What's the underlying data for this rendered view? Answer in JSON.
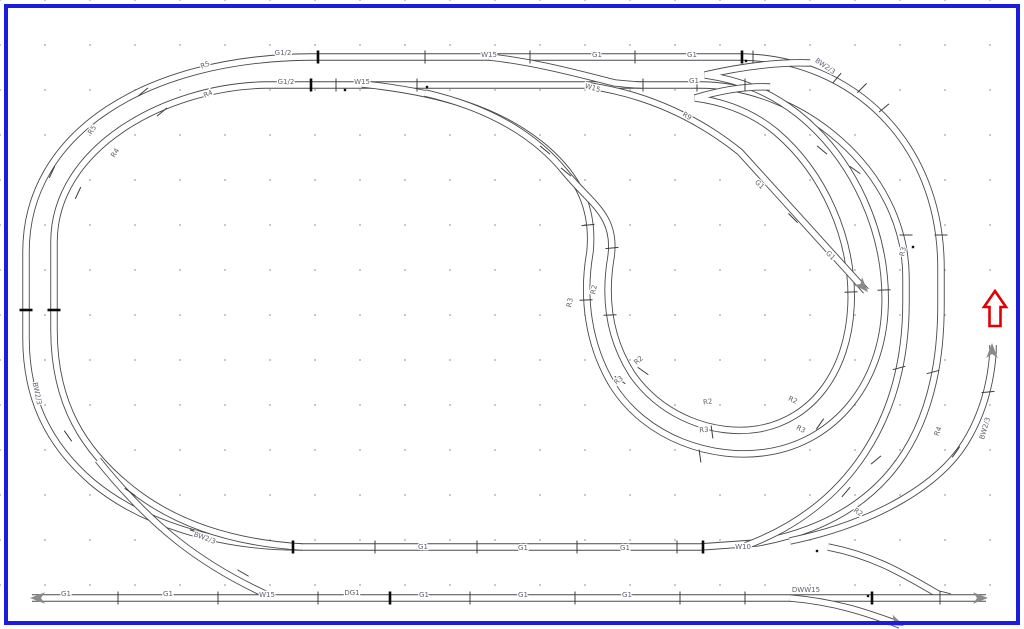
{
  "palette": {
    "frame": "#1c1ce0",
    "track": "#4a4a4a",
    "tick": "#3c3c3c",
    "tick_strong": "#0a0a0a",
    "label": "#5f5f6e",
    "end_arrow": "#8a8a8a",
    "red_arrow": "#e00000",
    "grid_dot": "#b5b5b5"
  },
  "plan": {
    "labels": [
      {
        "text": "G1/2",
        "x": 283,
        "y": 55,
        "r": 0
      },
      {
        "text": "W15",
        "x": 489,
        "y": 57,
        "r": 0
      },
      {
        "text": "G1",
        "x": 597,
        "y": 57,
        "r": 0
      },
      {
        "text": "G1",
        "x": 692,
        "y": 57,
        "r": 0
      },
      {
        "text": "BW2/3",
        "x": 824,
        "y": 68,
        "r": 35
      },
      {
        "text": "G1/2",
        "x": 286,
        "y": 84,
        "r": 0
      },
      {
        "text": "W15",
        "x": 362,
        "y": 84,
        "r": 0
      },
      {
        "text": "W15",
        "x": 592,
        "y": 90,
        "r": 16
      },
      {
        "text": "G1",
        "x": 694,
        "y": 83,
        "r": 0
      },
      {
        "text": "R9",
        "x": 686,
        "y": 118,
        "r": 30
      },
      {
        "text": "R5",
        "x": 206,
        "y": 67,
        "r": -22
      },
      {
        "text": "R4",
        "x": 209,
        "y": 96,
        "r": -24
      },
      {
        "text": "R5",
        "x": 94,
        "y": 131,
        "r": -58
      },
      {
        "text": "R4",
        "x": 117,
        "y": 154,
        "r": -58
      },
      {
        "text": "G1",
        "x": 758,
        "y": 186,
        "r": 45
      },
      {
        "text": "G1",
        "x": 829,
        "y": 257,
        "r": 45
      },
      {
        "text": "R3",
        "x": 905,
        "y": 252,
        "r": -78
      },
      {
        "text": "R2",
        "x": 596,
        "y": 290,
        "r": -78
      },
      {
        "text": "R3",
        "x": 572,
        "y": 303,
        "r": -78
      },
      {
        "text": "R2",
        "x": 640,
        "y": 362,
        "r": -40
      },
      {
        "text": "R3",
        "x": 620,
        "y": 382,
        "r": -40
      },
      {
        "text": "R2",
        "x": 708,
        "y": 404,
        "r": -8
      },
      {
        "text": "R3",
        "x": 704,
        "y": 432,
        "r": -4
      },
      {
        "text": "R2",
        "x": 792,
        "y": 402,
        "r": 24
      },
      {
        "text": "R3",
        "x": 800,
        "y": 431,
        "r": 26
      },
      {
        "text": "R4",
        "x": 940,
        "y": 432,
        "r": -68
      },
      {
        "text": "BW2/3",
        "x": 987,
        "y": 429,
        "r": -74
      },
      {
        "text": "BW2/3",
        "x": 35,
        "y": 394,
        "r": 78
      },
      {
        "text": "BW2/3",
        "x": 204,
        "y": 540,
        "r": 20
      },
      {
        "text": "G1",
        "x": 423,
        "y": 549,
        "r": 0
      },
      {
        "text": "G1",
        "x": 523,
        "y": 550,
        "r": 0
      },
      {
        "text": "G1",
        "x": 625,
        "y": 550,
        "r": 0
      },
      {
        "text": "W10",
        "x": 743,
        "y": 549,
        "r": 0
      },
      {
        "text": "R2",
        "x": 857,
        "y": 514,
        "r": 34
      },
      {
        "text": "G1",
        "x": 66,
        "y": 596,
        "r": 0
      },
      {
        "text": "G1",
        "x": 168,
        "y": 596,
        "r": 0
      },
      {
        "text": "W15",
        "x": 267,
        "y": 597,
        "r": 0
      },
      {
        "text": "DG1",
        "x": 352,
        "y": 595,
        "r": 0
      },
      {
        "text": "G1",
        "x": 424,
        "y": 597,
        "r": 0
      },
      {
        "text": "G1",
        "x": 523,
        "y": 597,
        "r": 0
      },
      {
        "text": "G1",
        "x": 627,
        "y": 597,
        "r": 0
      },
      {
        "text": "DWW15",
        "x": 806,
        "y": 592,
        "r": 0
      }
    ],
    "joint_ticks": [
      [
        318,
        57,
        0,
        1
      ],
      [
        425,
        57,
        0,
        0
      ],
      [
        530,
        57,
        0,
        0
      ],
      [
        635,
        57,
        0,
        0
      ],
      [
        742,
        57,
        0,
        1
      ],
      [
        753,
        57,
        0,
        0
      ],
      [
        311,
        85,
        0,
        1
      ],
      [
        336,
        85,
        0,
        0
      ],
      [
        417,
        85,
        0,
        0
      ],
      [
        643,
        85,
        0,
        0
      ],
      [
        697,
        85,
        0,
        0
      ],
      [
        745,
        85,
        0,
        0
      ],
      [
        143,
        92,
        50,
        0
      ],
      [
        162,
        112,
        50,
        0
      ],
      [
        52,
        172,
        25,
        0
      ],
      [
        78,
        193,
        25,
        0
      ],
      [
        26,
        310,
        90,
        1
      ],
      [
        54,
        310,
        90,
        1
      ],
      [
        68,
        436,
        -35,
        0
      ],
      [
        130,
        492,
        -55,
        0
      ],
      [
        196,
        532,
        -70,
        0
      ],
      [
        243,
        573,
        -60,
        0
      ],
      [
        293,
        547,
        0,
        1
      ],
      [
        375,
        547,
        0,
        0
      ],
      [
        477,
        547,
        0,
        0
      ],
      [
        577,
        547,
        0,
        0
      ],
      [
        677,
        547,
        0,
        0
      ],
      [
        703,
        547,
        0,
        1
      ],
      [
        118,
        598,
        0,
        0
      ],
      [
        218,
        598,
        0,
        0
      ],
      [
        318,
        598,
        0,
        0
      ],
      [
        390,
        598,
        0,
        1
      ],
      [
        470,
        598,
        0,
        0
      ],
      [
        575,
        598,
        0,
        0
      ],
      [
        680,
        598,
        0,
        0
      ],
      [
        745,
        598,
        0,
        0
      ],
      [
        872,
        598,
        0,
        1
      ],
      [
        940,
        598,
        0,
        0
      ],
      [
        837,
        78,
        40,
        0
      ],
      [
        862,
        88,
        45,
        0
      ],
      [
        884,
        108,
        50,
        0
      ],
      [
        941,
        235,
        90,
        0
      ],
      [
        906,
        235,
        90,
        0
      ],
      [
        933,
        372,
        75,
        0
      ],
      [
        899,
        368,
        75,
        0
      ],
      [
        876,
        460,
        50,
        0
      ],
      [
        846,
        492,
        40,
        0
      ],
      [
        588,
        225,
        85,
        0
      ],
      [
        612,
        248,
        85,
        0
      ],
      [
        586,
        300,
        88,
        0
      ],
      [
        610,
        315,
        88,
        0
      ],
      [
        620,
        380,
        -55,
        0
      ],
      [
        643,
        371,
        -55,
        0
      ],
      [
        700,
        456,
        -8,
        0
      ],
      [
        712,
        432,
        -8,
        0
      ],
      [
        820,
        424,
        35,
        0
      ],
      [
        884,
        290,
        88,
        0
      ],
      [
        851,
        292,
        88,
        0
      ],
      [
        855,
        170,
        -55,
        0
      ],
      [
        822,
        150,
        -50,
        0
      ],
      [
        793,
        218,
        -45,
        0
      ],
      [
        956,
        452,
        35,
        0
      ],
      [
        988,
        392,
        85,
        0
      ],
      [
        545,
        150,
        -50,
        0
      ],
      [
        566,
        172,
        -50,
        0
      ]
    ],
    "turnout_dots": [
      [
        427,
        87
      ],
      [
        746,
        61
      ],
      [
        817,
        551
      ],
      [
        868,
        596
      ],
      [
        913,
        247
      ],
      [
        345,
        90
      ]
    ],
    "end_arrows": [
      {
        "x": 30,
        "y": 598,
        "a": 180
      },
      {
        "x": 988,
        "y": 598,
        "a": 0
      },
      {
        "x": 904,
        "y": 626,
        "a": 24
      },
      {
        "x": 868,
        "y": 292,
        "a": 47
      },
      {
        "x": 992,
        "y": 343,
        "a": -90
      }
    ],
    "red_arrow": {
      "x": 995,
      "y": 308
    }
  }
}
